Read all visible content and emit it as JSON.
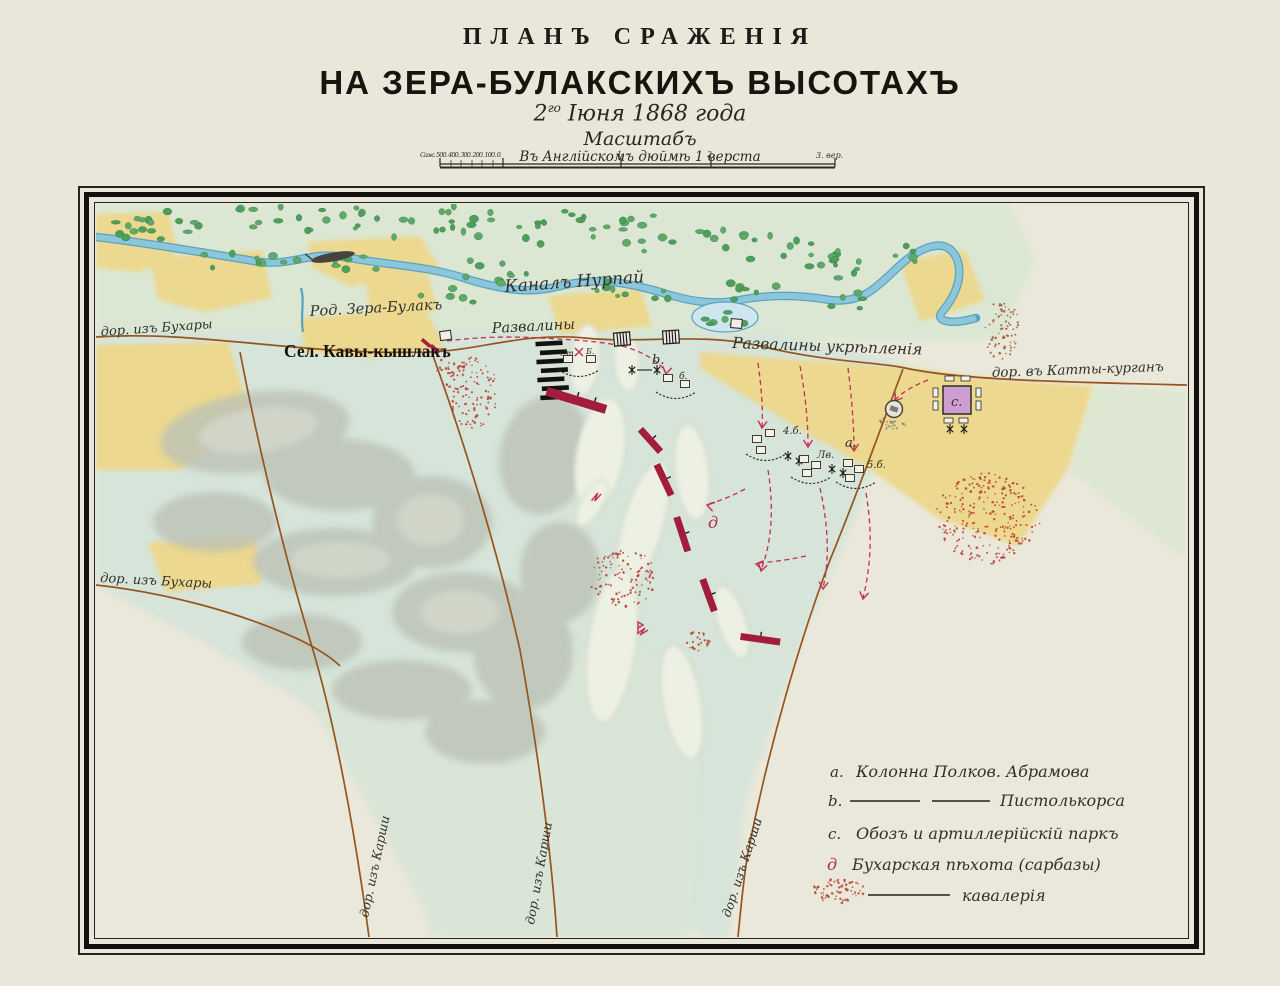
{
  "title": {
    "line1": "ПЛАНЪ СРАЖЕНІЯ",
    "line2": "НА ЗЕРА-БУЛАКСКИХЪ ВЫСОТАХЪ",
    "date_num": "2",
    "date_sup": "го",
    "date_rest": " Іюня 1868 года"
  },
  "scale": {
    "heading": "Масштабъ",
    "subtitle": "Въ Англійскомъ дюймѣ 1 верста",
    "bar_left": "Саж. 500. 400. 300. 200. 100. 0.",
    "tick1": "1.",
    "tick2": "2.",
    "tick3": "3. вер."
  },
  "map_labels": {
    "canal": "Каналъ Нурпай",
    "spring": "Род. Зера-Булакъ",
    "village": "Сел. Кавы-кышлакъ",
    "ruins": "Развалины",
    "fort_ruins": "Развалины укрѣпленія",
    "road_bukhara": "дор. изъ Бухары",
    "road_bukhara2": "дор. изъ Бухары",
    "road_katty": "дор. въ Катты-курганъ",
    "road_karshi": "дор. изъ Карши"
  },
  "units": {
    "st": "Ст.",
    "bat": "Б.",
    "b": "b.",
    "b_small": "б.",
    "bat4": "4.б.",
    "lv": "Лв.",
    "a": "а.",
    "bat5": "5.б.",
    "c": "с.",
    "d": "д"
  },
  "legend": {
    "items": [
      {
        "letter": "а.",
        "text": "Колонна Полков. Абрамова"
      },
      {
        "letter": "b.",
        "text": "Пистолькорса"
      },
      {
        "letter": "с.",
        "text": "Обозъ и артиллерійскій паркъ"
      },
      {
        "letter": "д",
        "text": "Бухарская пѣхота (сарбазы)"
      },
      {
        "letter": "",
        "text": "кавалерія"
      }
    ]
  },
  "colors": {
    "paper": "#e9e7da",
    "green_wash": "#dbe7d3",
    "teal_wash": "#d6e4d9",
    "yellow_field": "#ecd88e",
    "canal_blue": "#8cc6db",
    "canal_edge": "#5aa3c0",
    "tree_green": "#4f9e5b",
    "road_brown": "#96541f",
    "crimson_unit": "#a41c3c",
    "red_dash": "#c43050",
    "stipple_red": "#b5402e",
    "park_pink": "#cf9ed0",
    "ink_black": "#16140f"
  }
}
